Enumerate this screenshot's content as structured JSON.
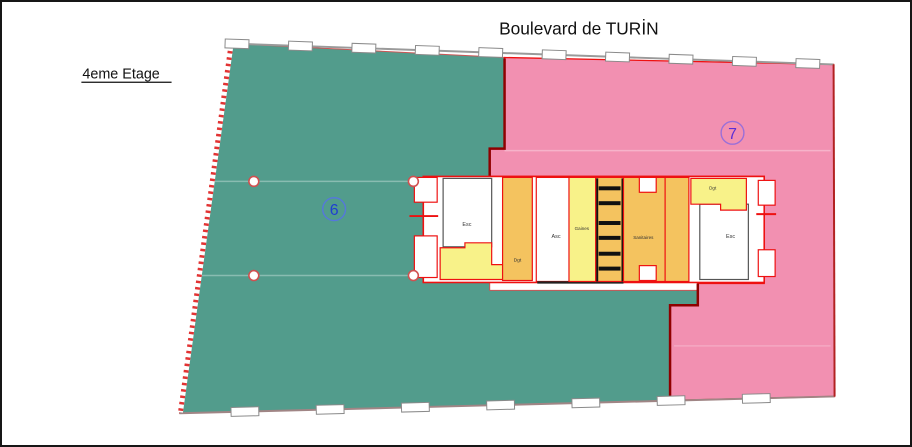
{
  "title": "Boulevard de TURİN",
  "floor_label": "4eme Etage",
  "zones": {
    "left": {
      "number": "6"
    },
    "right": {
      "number": "7"
    }
  },
  "core_rooms": {
    "stairs_left": "Esc",
    "corridor_left": "Dgt",
    "elevator": "Asc",
    "shafts": "Gaines",
    "toilets": "Sanitaires",
    "corridor_right": "Dgt",
    "stairs_right": "Esc"
  },
  "colors": {
    "zone6_fill": "#529c8c",
    "zone7_fill": "#f290b1",
    "corridor_fill": "#f4c35f",
    "service_fill": "#f8f289",
    "wall_red": "#ee1111",
    "boundary_dark_red": "#8f0000",
    "zone6_label": "#1f3ed2",
    "zone7_label": "#5b2fd4"
  }
}
